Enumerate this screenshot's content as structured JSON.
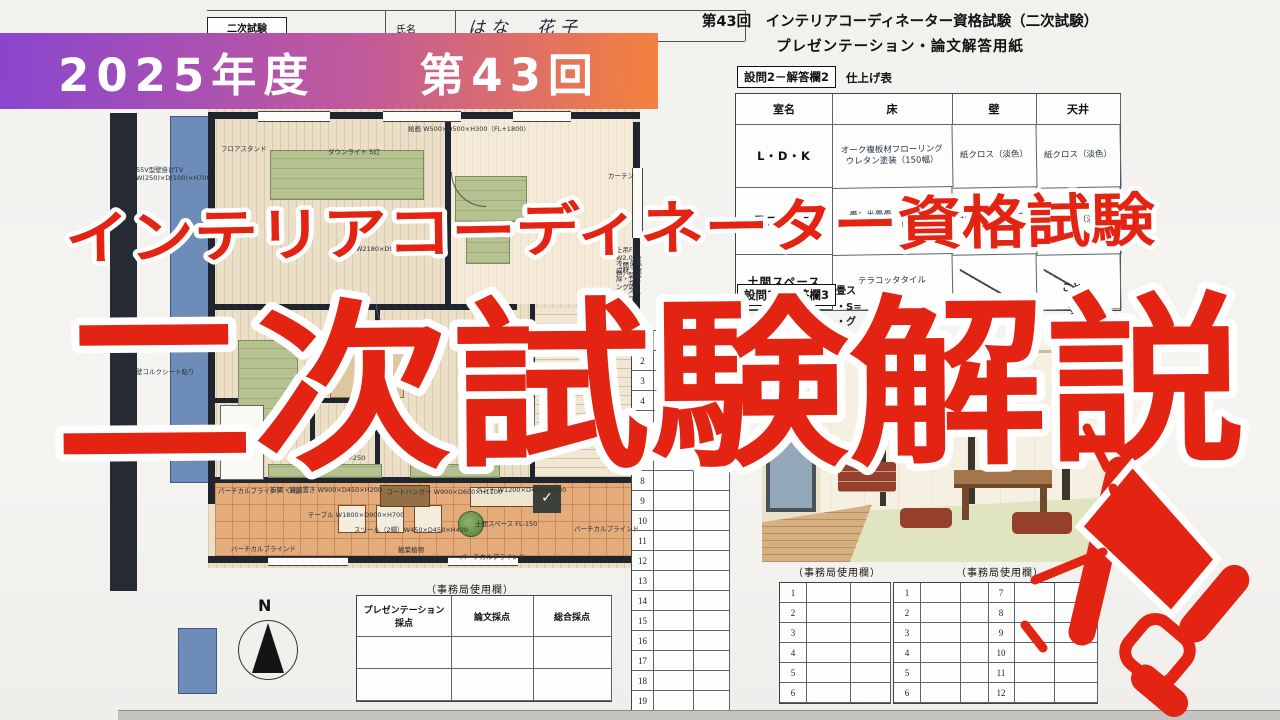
{
  "banner": {
    "label": "2025年度　　第43回",
    "gradient_from": "#8a45cf",
    "gradient_to": "#f5813d"
  },
  "overlay": {
    "line1": "インテリアコーディネーター資格試験",
    "line2": "二次試験解説",
    "accent_red": "#e32413"
  },
  "name_strip": {
    "exam_label": "二次試験",
    "name_label": "氏名",
    "name_value": "はな　花子"
  },
  "sheet_header": {
    "title_line1": "第43回　インテリアコーディネーター資格試験（二次試験）",
    "title_line2": "プレゼンテーション・論文解答用紙",
    "q2_label": "設問2－解答欄2",
    "q2_caption": "仕上げ表",
    "q3_label": "設問3－解答欄3"
  },
  "finish_table": {
    "headers": [
      "室名",
      "床",
      "壁",
      "天井"
    ],
    "rows": [
      [
        "L・D・K",
        "オーク複板材フローリング\nウレタン塗装（150幅）",
        "紙クロス（淡色）",
        "紙クロス（淡色）"
      ],
      [
        "畳スペース",
        "畳：半畳畳（縁なし）\n板敷き：ヒバ",
        "西側：コルクシート貼り",
        "紙クロス（淡色）"
      ],
      [
        "土間スペース",
        "テラコッタタイル",
        "",
        ""
      ]
    ]
  },
  "q3_fragments": {
    "a": "畳ス",
    "b": "・S=",
    "c": "・グ",
    "d": "こと",
    "e": "す"
  },
  "middle_sheet": {
    "row_numbers": [
      1,
      2,
      3,
      4,
      5,
      6,
      7,
      8,
      9,
      10,
      11,
      12,
      13,
      14,
      15,
      16,
      17,
      18,
      19,
      20
    ]
  },
  "admin": {
    "caption_left": "（事務局使用欄）",
    "caption_right": "（事務局使用欄）",
    "caption_score": "（事務局使用欄）",
    "left_rows": [
      1,
      2,
      3,
      4,
      5,
      6
    ],
    "right_rows_a": [
      1,
      2,
      3,
      4,
      5,
      6
    ],
    "right_rows_b": [
      7,
      8,
      9,
      10,
      11,
      12
    ],
    "score_headers": [
      "プレゼンテーション\n採点",
      "論文採点",
      "総合採点"
    ]
  },
  "compass": {
    "label": "N"
  },
  "fridge_mark": "✓",
  "plan": {
    "annotations": [
      {
        "t": "絵画 W500×D500×H300（FL+1800）",
        "x": 300,
        "y": 27
      },
      {
        "t": "フロアスタンド",
        "x": 113,
        "y": 47
      },
      {
        "t": "ダウンライト 5灯",
        "x": 220,
        "y": 50
      },
      {
        "t": "55V型壁掛けTV\nW(250)×D(100)×H700",
        "x": 28,
        "y": 68
      },
      {
        "t": "カーテン",
        "x": 500,
        "y": 74
      },
      {
        "t": "W2180×D900×H700",
        "x": 248,
        "y": 147
      },
      {
        "t": "壁コルクシート貼り",
        "x": 28,
        "y": 270
      },
      {
        "t": "上吊FL W2,000（開き戸）",
        "x": 508,
        "y": 148
      },
      {
        "t": "オーク集成材（框扉・リビング内部）",
        "x": 508,
        "y": 161
      },
      {
        "t": "型板ガラス入り",
        "x": 520,
        "y": 173
      },
      {
        "t": "FL+250",
        "x": 232,
        "y": 356
      },
      {
        "t": "パーチカルブラインド（2倍）",
        "x": 110,
        "y": 389
      },
      {
        "t": "新聞・雑誌置き W900×D450×H200",
        "x": 162,
        "y": 388
      },
      {
        "t": "コートハンガー W900×D600×H1100",
        "x": 278,
        "y": 390
      },
      {
        "t": "ベンチ W1200×D450×H400",
        "x": 368,
        "y": 388
      },
      {
        "t": "テーブル W1800×D900×H700",
        "x": 200,
        "y": 413
      },
      {
        "t": "スツール（2脚）W450×D450×H420",
        "x": 246,
        "y": 428
      },
      {
        "t": "土間スペース FL-150",
        "x": 367,
        "y": 422
      },
      {
        "t": "観葉植物",
        "x": 290,
        "y": 448
      },
      {
        "t": "バーチカルブラインド",
        "x": 123,
        "y": 447
      },
      {
        "t": "パーチカルブラインド",
        "x": 352,
        "y": 455
      },
      {
        "t": "バーチカルブラインド",
        "x": 466,
        "y": 427
      }
    ]
  }
}
